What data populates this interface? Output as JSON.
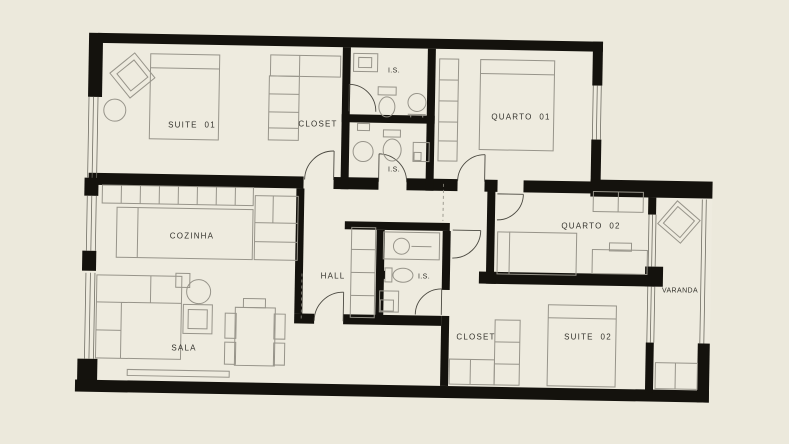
{
  "title": "Apartment floor plan",
  "colors": {
    "background": "#ECE9DC",
    "floor": "#EEEBDF",
    "wall": "#14120D",
    "furniture_line": "#97948A",
    "detail_line": "#4A4840",
    "window_line": "#6F6D63",
    "label_text": "#33322C"
  },
  "rooms": {
    "suite_01": {
      "label": "SUITE  01"
    },
    "closet_suite_01": {
      "label": "CLOSET"
    },
    "is_top": {
      "label": "I.S."
    },
    "is_mid": {
      "label": "I.S."
    },
    "quarto_01": {
      "label": "QUARTO  01"
    },
    "cozinha": {
      "label": "COZINHA"
    },
    "hall": {
      "label": "HALL"
    },
    "is_lower": {
      "label": "I.S."
    },
    "quarto_02": {
      "label": "QUARTO  02"
    },
    "varanda": {
      "label": "VARANDA"
    },
    "closet_suite_02": {
      "label": "CLOSET"
    },
    "suite_02": {
      "label": "SUITE  02"
    },
    "sala": {
      "label": "SALA"
    }
  }
}
